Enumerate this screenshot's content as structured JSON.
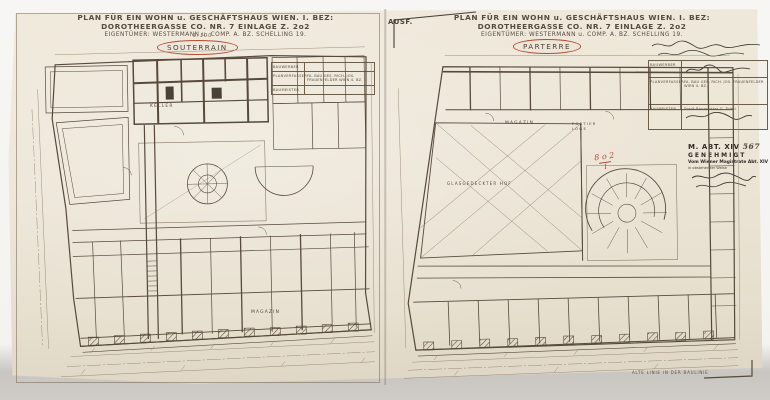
{
  "page": {
    "background": "#f4f3f0",
    "paper_color": "#ece5d6",
    "ink_color": "#4a3f34",
    "red_accent": "#b94c35"
  },
  "left_sheet": {
    "title": "PLAN FÜR EIN WOHN u. GESCHÄFTSHAUS WIEN. I. BEZ: DOROTHEERGASSE CO. NR. 7 EINLAGE Z. 2o2",
    "subtitle": "EIGENTÜMER: WESTERMANN u. COMP. A. BZ. SCHELLING 19.",
    "scale_note": "1:100",
    "floor_label": "SOUTERRAIN",
    "info_table": {
      "rows": [
        {
          "label": "BAUWERBER",
          "value": ""
        },
        {
          "label": "PLANVERFASSER",
          "value": "FA. BAU GES. RICH. JOS. FRAUENFELDER WIEN 4. BZ."
        },
        {
          "label": "BAUMEISTER",
          "value": ""
        }
      ]
    },
    "room_labels": [
      {
        "text": "KELLER"
      },
      {
        "text": "MAGAZIN"
      }
    ]
  },
  "right_sheet": {
    "handwritten_prefix": "AUSF.",
    "title": "PLAN FÜR EIN WOHN u. GESCHÄFTSHAUS WIEN. I. BEZ: DOROTHEERGASSE CO. NR. 7 EINLAGE Z. 2o2",
    "subtitle": "EIGENTÜMER: WESTERMANN u. COMP. A. BZ. SCHELLING 19.",
    "floor_label": "PARTERRE",
    "plan_number": "8 o 2",
    "plan_number_denominator": "I",
    "info_table": {
      "rows": [
        {
          "label": "BAUWERBER",
          "value": ""
        },
        {
          "label": "PLANVERFASSER",
          "value": "FA. BAU GES. RICH. JOS. FRAUENFELDER WIEN 4. BZ."
        },
        {
          "label": "BAUMEISTER",
          "value": "Stadt-Baumeister G. Tolsti"
        }
      ]
    },
    "stamp": {
      "line1": "M. ABT. XIV",
      "line1_hand": "567",
      "line2": "GENEHMIGT",
      "line3": "Vom Wiener Magistrate Abt. XIV",
      "line4": "in obstehender Weise"
    },
    "room_labels": [
      {
        "text": "MAGAZIN"
      },
      {
        "text": "PORTIER LOGE"
      },
      {
        "text": "GLASGEDECKTER HOF"
      }
    ],
    "bottom_note": "ALTE LINIE IN DER BAULINIE"
  }
}
